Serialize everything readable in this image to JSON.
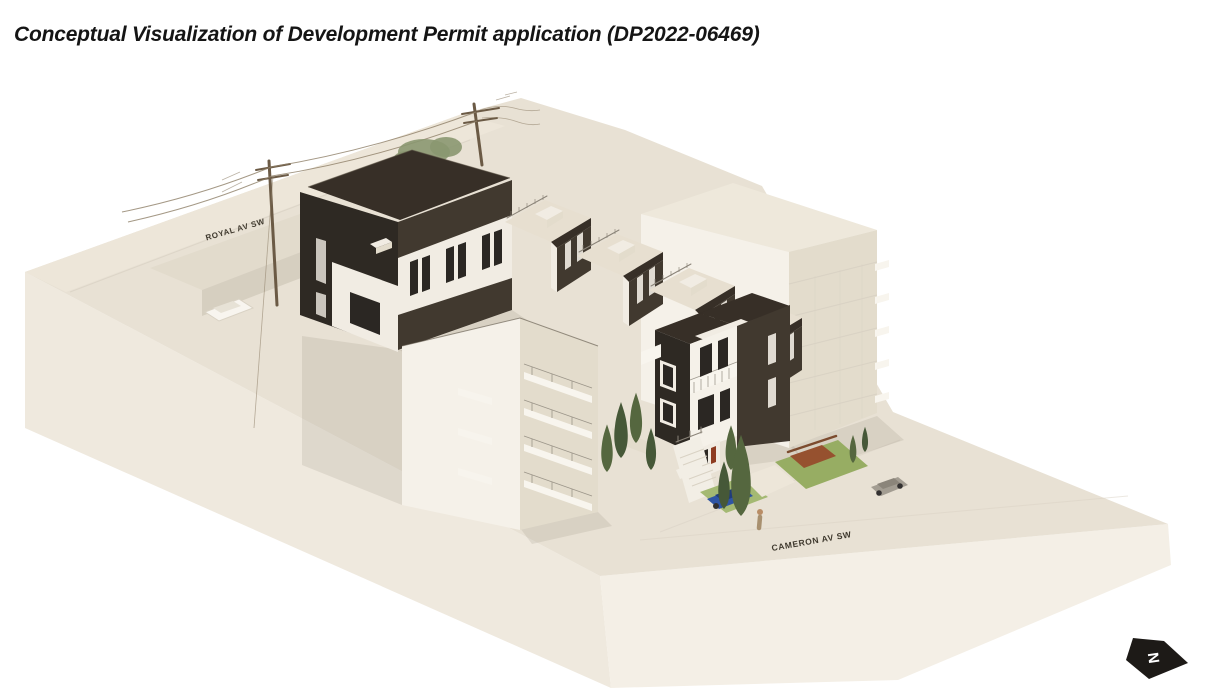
{
  "title": {
    "text": "Conceptual Visualization of Development Permit application (DP2022-06469)"
  },
  "figure": {
    "street_labels": [
      {
        "id": "royal",
        "text": "ROYAL AV SW"
      },
      {
        "id": "cameron",
        "text": "CAMERON AV SW"
      }
    ],
    "north_arrow": {
      "letter": "N"
    }
  },
  "palette": {
    "page-bg": "#ffffff",
    "title-ink": "#151515",
    "label-ink": "#3f392e",
    "slab-top": "#e8e1d4",
    "slab-left": "#efe9de",
    "slab-right": "#f4efe6",
    "street-band": "#ede6d9",
    "terrace": "#e2dbcc",
    "terrace-face": "#d6cfc0",
    "wall-dark": "#41392f",
    "wall-darker": "#2e2923",
    "wall-white": "#f1ece3",
    "wall-bright": "#f5f1e9",
    "roof-dark": "#372f27",
    "roof-cream": "#e7dfd0",
    "bldg-cream": "#eee8db",
    "bldg-shade": "#e3dccc",
    "balcony": "#f8f5ee",
    "win-dark": "#2b2723",
    "lawn": "#a4b973",
    "lawn-2": "#97ad63",
    "tree": "#55673f",
    "tree-dark": "#465838",
    "canopy": "#8a9770",
    "shrub": "#96512f",
    "fence": "#7c4b2e",
    "car-blue": "#2f55a4",
    "car-blue-dark": "#203c7c",
    "car-grey": "#a39d92",
    "car-grey-dark": "#8b857a",
    "car-white": "#f8f5ef",
    "car-white-shade": "#e7e2d6",
    "wheel": "#333130",
    "wire": "#8d7e67",
    "pole": "#6b5a45",
    "line-soft": "#d9d2c4",
    "stair": "#f2eee5",
    "rail": "#8a8378",
    "parapet": "#5a5244",
    "shadow": "#4a4234",
    "arrow": "#1d1a17",
    "skin": "#b98d66",
    "figure-tan": "#a8906f",
    "door-red": "#8e3c22"
  }
}
